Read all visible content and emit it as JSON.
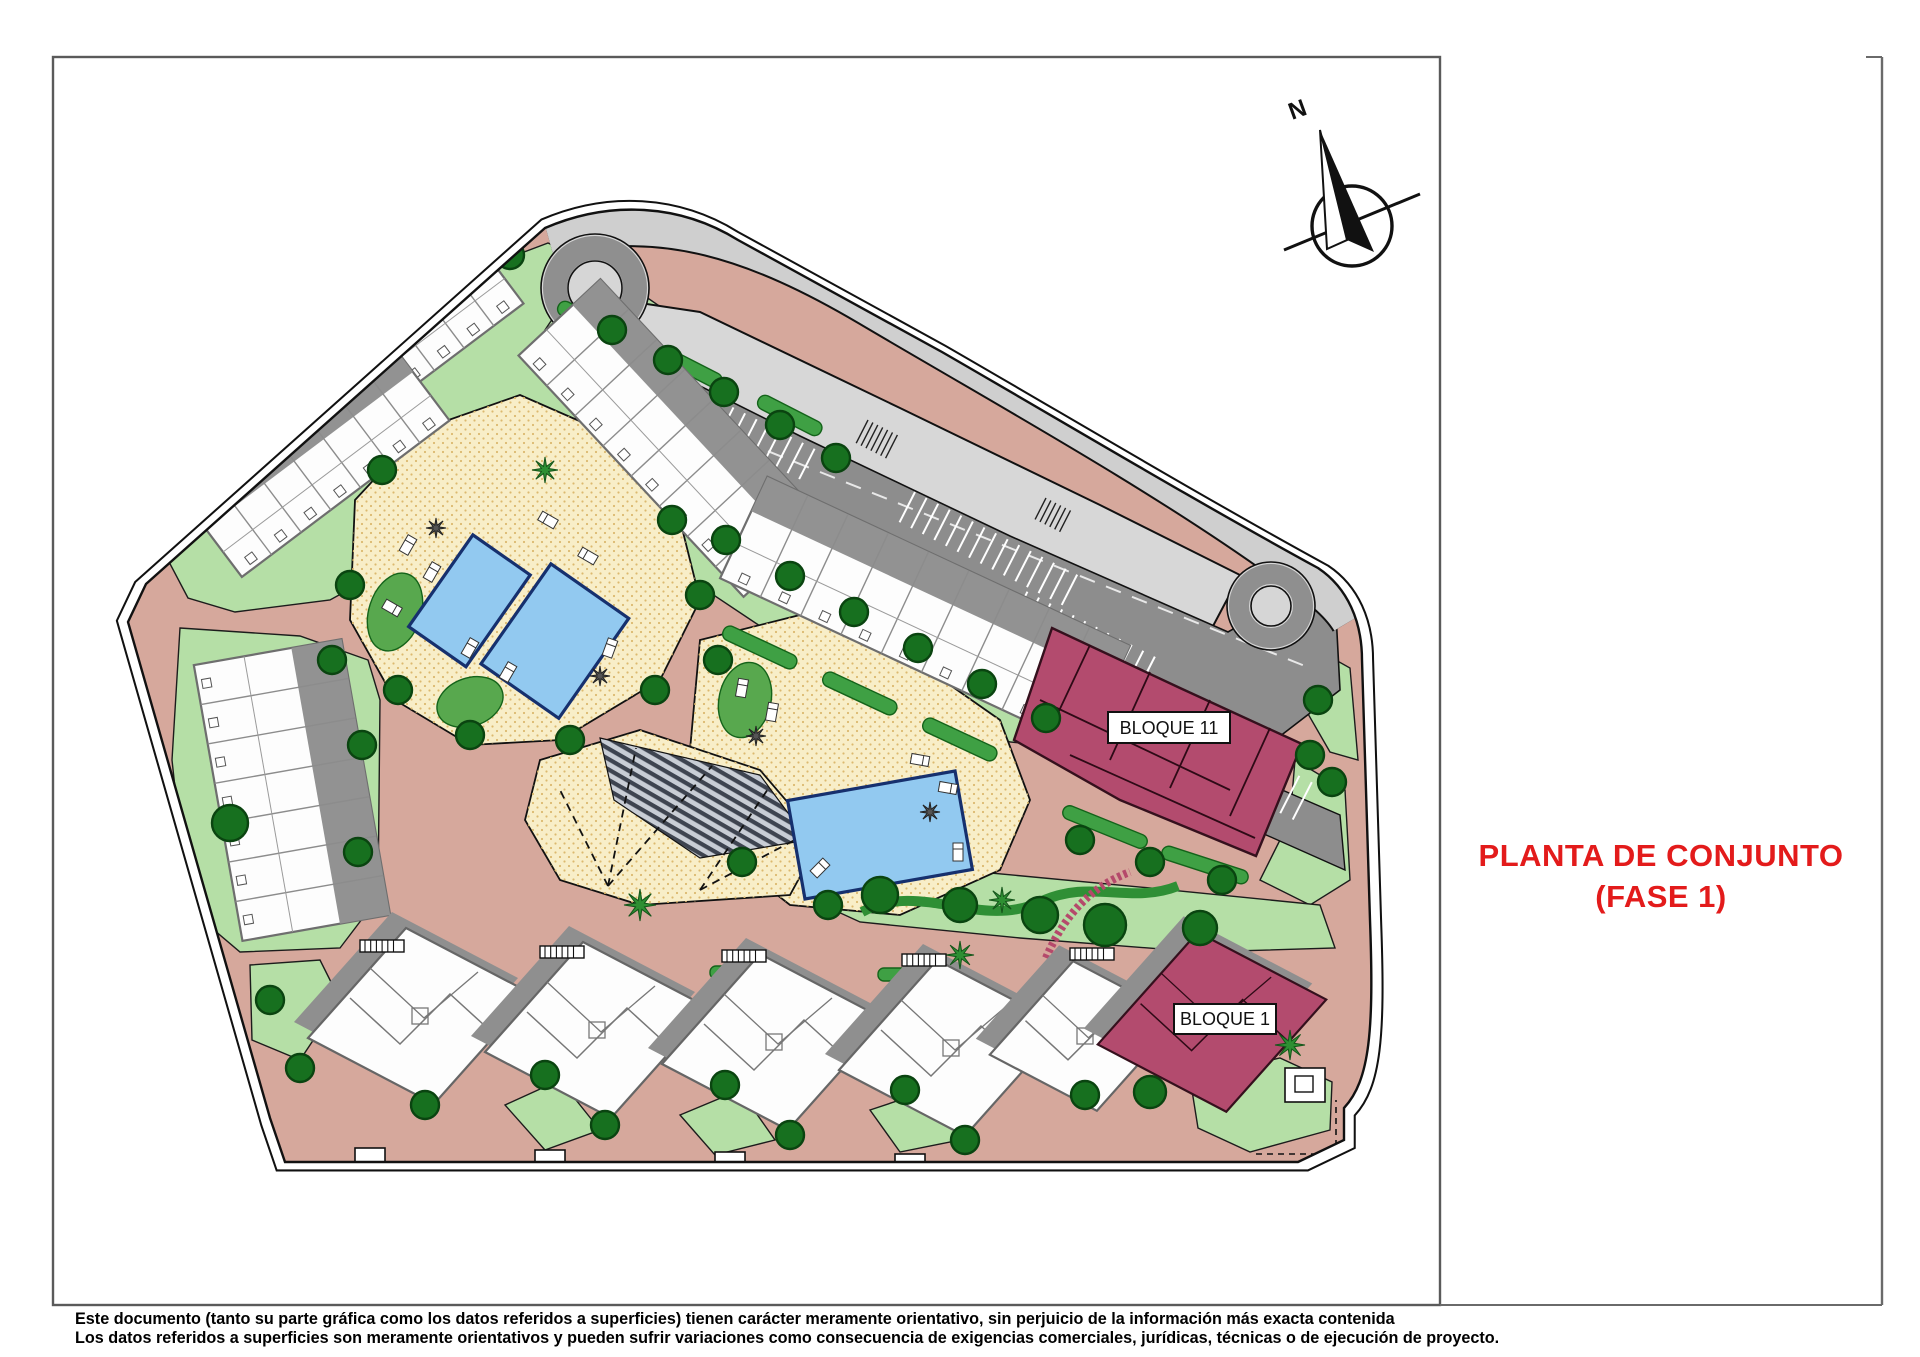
{
  "sheet": {
    "title": {
      "line1": "PLANTA DE CONJUNTO",
      "line2": "(FASE 1)"
    },
    "footer": {
      "line1": "Este documento (tanto su parte gráfica como los datos referidos a superficies) tienen carácter meramente orientativo, sin perjuicio de la información más exacta contenida",
      "line2": "Los datos referidos a superficies son meramente orientativos y pueden sufrir variaciones como consecuencia de exigencias comerciales, jurídicas, técnicas o de ejecución de proyecto."
    }
  },
  "plan": {
    "north_label": "N",
    "blocks": {
      "bloque_11": "BLOQUE 11",
      "bloque_1": "BLOQUE 1"
    },
    "colors": {
      "title_red": "#e31b1b",
      "block_red": "#b34b6e",
      "road_pink": "#d6a89c",
      "lawn_green": "#b5dfa6",
      "hedge_green": "#3fa044",
      "tree_green": "#17701f",
      "deck_cream": "#f8eec8",
      "pool_blue": "#92c9f0",
      "parking_dark": "#8d8d8d",
      "parking_light": "#d6d6d6",
      "building_white": "#fdfdfd"
    }
  }
}
